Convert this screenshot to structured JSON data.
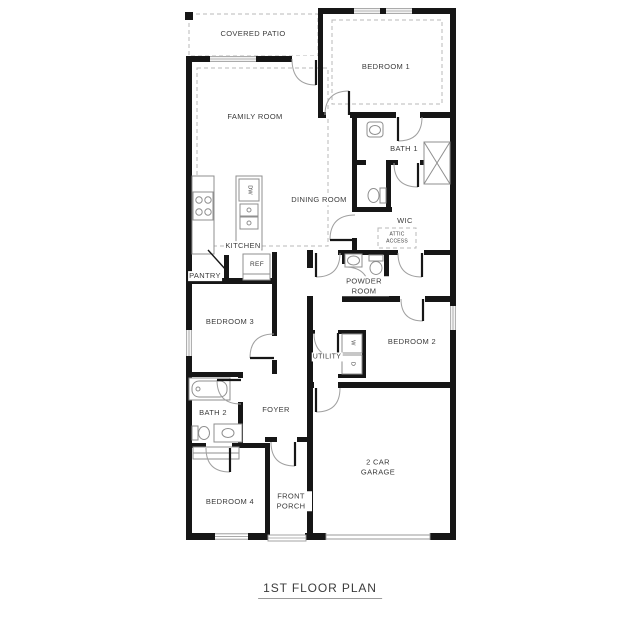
{
  "title": "1ST FLOOR PLAN",
  "rooms": {
    "covered_patio": "COVERED PATIO",
    "family_room": "FAMILY ROOM",
    "bedroom1": "BEDROOM 1",
    "bath1": "BATH 1",
    "dining_room": "DINING ROOM",
    "wic": "WIC",
    "attic_access": "ATTIC ACCESS",
    "kitchen": "KITCHEN",
    "pantry": "PANTRY",
    "powder_room": "POWDER ROOM",
    "bedroom3": "BEDROOM 3",
    "bedroom2": "BEDROOM 2",
    "utility": "UTILITY",
    "bath2": "BATH 2",
    "foyer": "FOYER",
    "bedroom4": "BEDROOM 4",
    "front_porch": "FRONT PORCH",
    "garage": "2 CAR GARAGE"
  },
  "appliances": {
    "dishwasher": "DW",
    "refrigerator": "REF",
    "washer": "W",
    "dryer": "D"
  },
  "colors": {
    "wall": "#161616",
    "fixture_line": "#8f8f8f",
    "dashed_line": "#b8b8b8",
    "text": "#3b3b3b"
  }
}
